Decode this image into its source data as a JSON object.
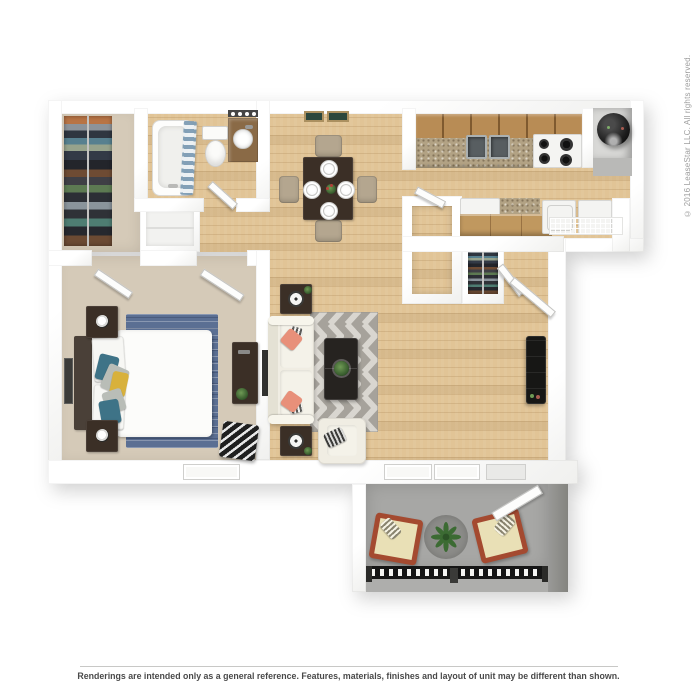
{
  "texts": {
    "disclaimer": "Renderings are intended only as a general reference. Features, materials, finishes and layout of unit may be different than shown.",
    "copyright": "© 2016 LeaseStar LLC. All rights reserved."
  },
  "palette": {
    "wall": "#ffffff",
    "wall-edge": "#dcdcda",
    "wood": "#e1c496",
    "carpet": "#d5cab8",
    "patio-floor": "#a7a7a5",
    "patio-wall": "#90908e",
    "rug-dark": "#a6a29b",
    "rug-light": "#d9d6d0",
    "bed-rug": "#5b6f93",
    "sofa": "#f0ede3",
    "coral": "#e8907a",
    "teal": "#3e7387",
    "yellow": "#d8b13c",
    "dark-wood": "#3b2f26",
    "near-black": "#1d1d1d",
    "cabinet": "#b88c55",
    "granite": "#b2a284",
    "chair-tan": "#b4a68f",
    "patio-chair": "#a44a30",
    "cushion": "#e9e0b6",
    "plant-green": "#44703a",
    "railing": "#1f1f1f",
    "text-muted": "#9e9e9e",
    "text-footer": "#4a4a4a"
  },
  "scene": {
    "type": "3d-floor-plan-rendering",
    "rooms": [
      "walk-in-closet",
      "bathroom",
      "dining-area",
      "kitchen",
      "bedroom",
      "living-room",
      "entry-foyer",
      "pantry",
      "coat-closet",
      "patio"
    ],
    "furniture": [
      "clothes-rack",
      "bathtub",
      "shower-curtain",
      "toilet",
      "vanity-sink",
      "vanity-lights",
      "dining-table",
      "dining-chairs",
      "dinner-plates",
      "upper-cabinets",
      "kitchen-sink",
      "stove",
      "water-heater",
      "washer",
      "dryer",
      "wire-shelf",
      "breakfast-bar",
      "bed",
      "nightstands",
      "table-lamps",
      "bedroom-area-rug",
      "desk",
      "chevron-pouf",
      "wall-art",
      "sofa",
      "throw-pillows",
      "side-tables",
      "chevron-area-rug",
      "coffee-table",
      "accent-chair",
      "tv-console",
      "patio-chairs",
      "patio-round-rug",
      "potted-plant",
      "balcony-railing"
    ]
  }
}
